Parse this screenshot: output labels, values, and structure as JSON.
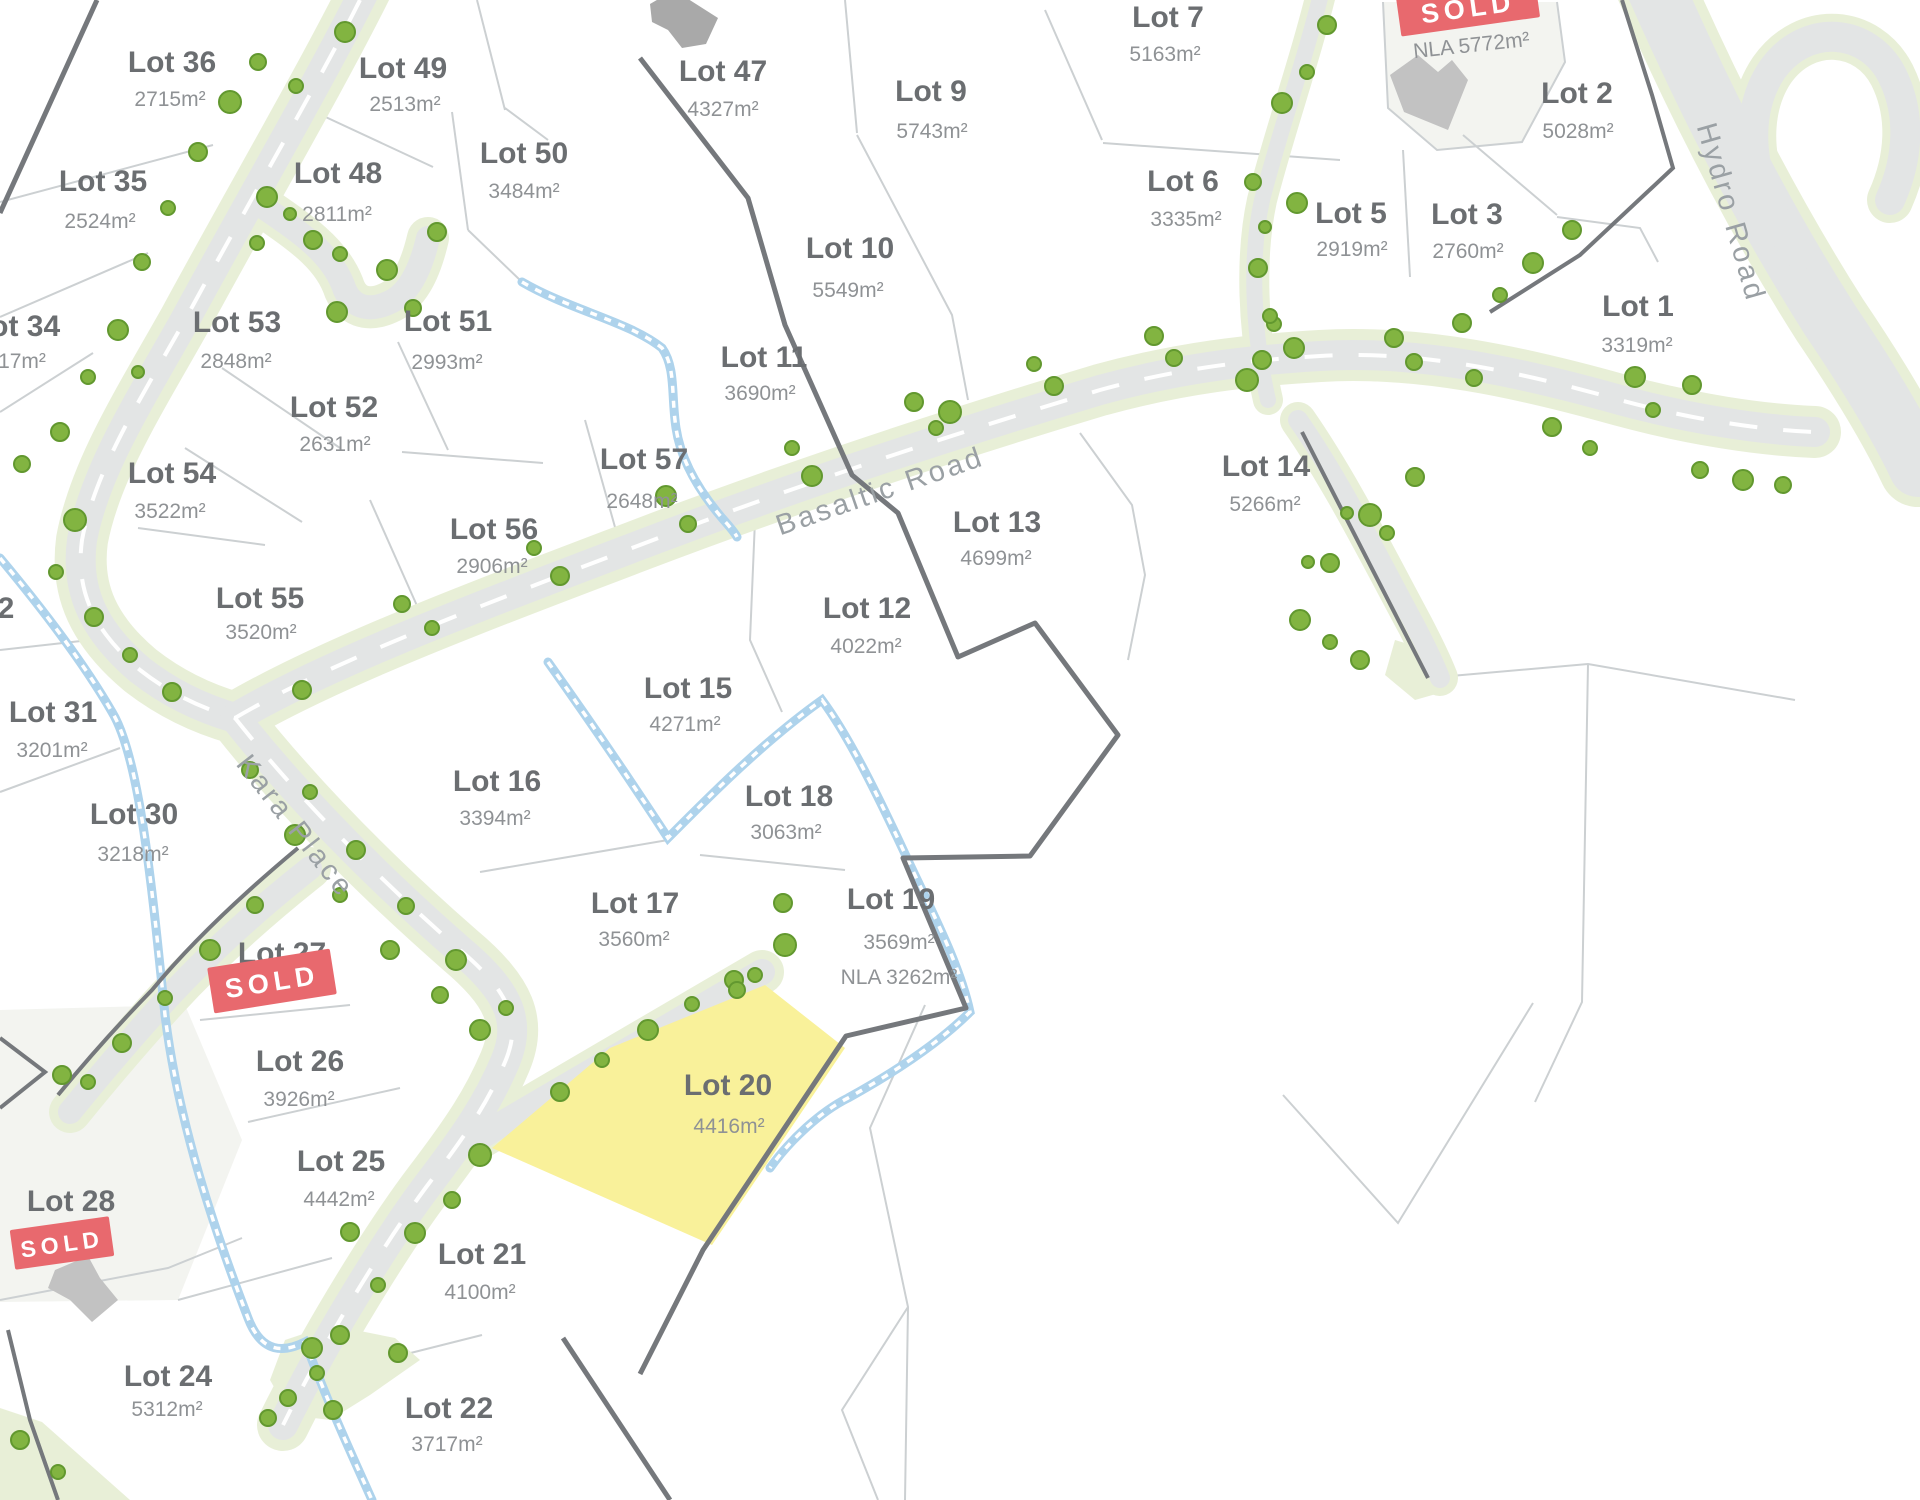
{
  "map": {
    "colors": {
      "highlight_yellow": "#f9f19a",
      "sold_red": "#e8696e",
      "tree_green": "#82b441",
      "road_gray": "#e3e5e5",
      "verge_green": "#e8efd7",
      "creek_blue": "#aed3ec",
      "boundary_dark": "#75787c"
    },
    "roads": {
      "basaltic": "Basaltic Road",
      "kara": "Kara Place",
      "hydro": "Hydro Road"
    },
    "sold_badges": {
      "label": "SOLD"
    },
    "unlabeled_sold_lot": {
      "nla_area": "NLA 5772m²"
    },
    "stray_labels": [
      {
        "text": "2"
      }
    ],
    "lots": [
      {
        "name": "Lot 1",
        "area": "3319m²"
      },
      {
        "name": "Lot 2",
        "area": "5028m²"
      },
      {
        "name": "Lot 3",
        "area": "2760m²"
      },
      {
        "name": "Lot 5",
        "area": "2919m²"
      },
      {
        "name": "Lot 6",
        "area": "3335m²"
      },
      {
        "name": "Lot 7",
        "area": "5163m²"
      },
      {
        "name": "Lot 9",
        "area": "5743m²"
      },
      {
        "name": "Lot 10",
        "area": "5549m²"
      },
      {
        "name": "Lot 11",
        "area": "3690m²"
      },
      {
        "name": "Lot 12",
        "area": "4022m²"
      },
      {
        "name": "Lot 13",
        "area": "4699m²"
      },
      {
        "name": "Lot 14",
        "area": "5266m²"
      },
      {
        "name": "Lot 15",
        "area": "4271m²"
      },
      {
        "name": "Lot 16",
        "area": "3394m²"
      },
      {
        "name": "Lot 17",
        "area": "3560m²"
      },
      {
        "name": "Lot 18",
        "area": "3063m²"
      },
      {
        "name": "Lot 19",
        "area": "3569m²",
        "nla": "NLA 3262m²"
      },
      {
        "name": "Lot 20",
        "area": "4416m²",
        "highlighted": true
      },
      {
        "name": "Lot 21",
        "area": "4100m²"
      },
      {
        "name": "Lot 22",
        "area": "3717m²"
      },
      {
        "name": "Lot 24",
        "area": "5312m²"
      },
      {
        "name": "Lot 25",
        "area": "4442m²"
      },
      {
        "name": "Lot 26",
        "area": "3926m²"
      },
      {
        "name": "Lot 27",
        "status": "SOLD"
      },
      {
        "name": "Lot 28",
        "status": "SOLD"
      },
      {
        "name": "Lot 30",
        "area": "3218m²"
      },
      {
        "name": "Lot 31",
        "area": "3201m²"
      },
      {
        "name": "Lot 34",
        "area": "17m²"
      },
      {
        "name": "Lot 35",
        "area": "2524m²"
      },
      {
        "name": "Lot 36",
        "area": "2715m²"
      },
      {
        "name": "Lot 47",
        "area": "4327m²"
      },
      {
        "name": "Lot 48",
        "area": "2811m²"
      },
      {
        "name": "Lot 49",
        "area": "2513m²"
      },
      {
        "name": "Lot 50",
        "area": "3484m²"
      },
      {
        "name": "Lot 51",
        "area": "2993m²"
      },
      {
        "name": "Lot 52",
        "area": "2631m²"
      },
      {
        "name": "Lot 53",
        "area": "2848m²"
      },
      {
        "name": "Lot 54",
        "area": "3522m²"
      },
      {
        "name": "Lot 55",
        "area": "3520m²"
      },
      {
        "name": "Lot 56",
        "area": "2906m²"
      },
      {
        "name": "Lot 57",
        "area": "2648m²"
      }
    ]
  }
}
